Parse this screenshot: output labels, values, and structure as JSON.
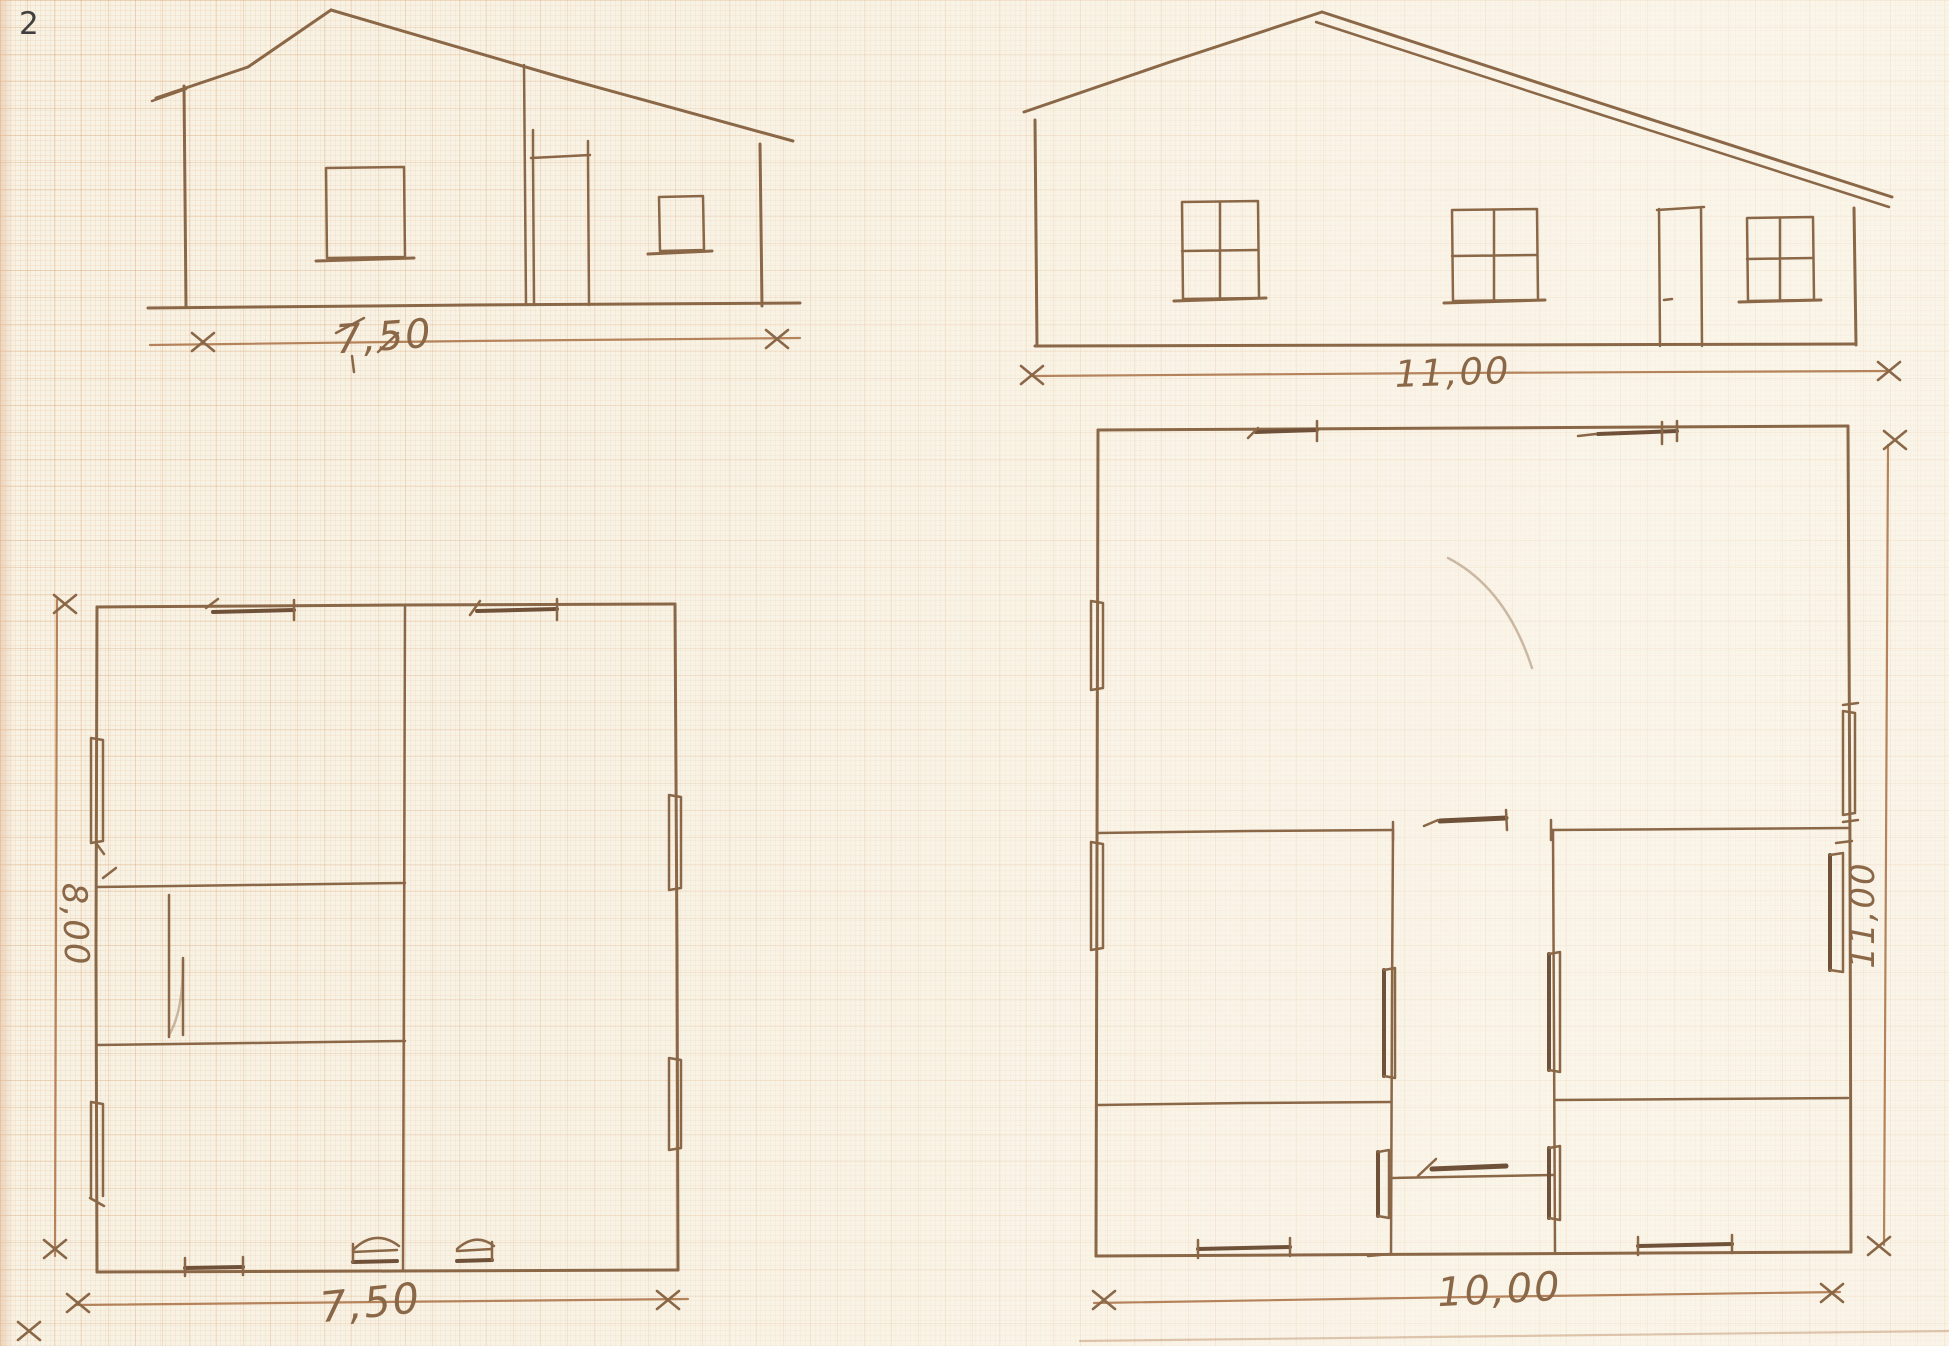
{
  "page": {
    "number": "2"
  },
  "elevations": {
    "left": {
      "width_dimension": "7,50"
    },
    "right": {
      "width_dimension": "11,00"
    }
  },
  "floor_plans": {
    "left": {
      "width_dimension": "7,50",
      "depth_dimension": "8,00"
    },
    "right": {
      "width_dimension": "10,00",
      "depth_dimension": "11,00"
    }
  },
  "symbols": {
    "dimension_end_marker": "x"
  },
  "colors": {
    "paper": "#f8f2e4",
    "ink": "#8a6747",
    "ink_light": "#b5835b",
    "ink_bold": "#6e5138",
    "page_number": "#3f3f3f"
  }
}
